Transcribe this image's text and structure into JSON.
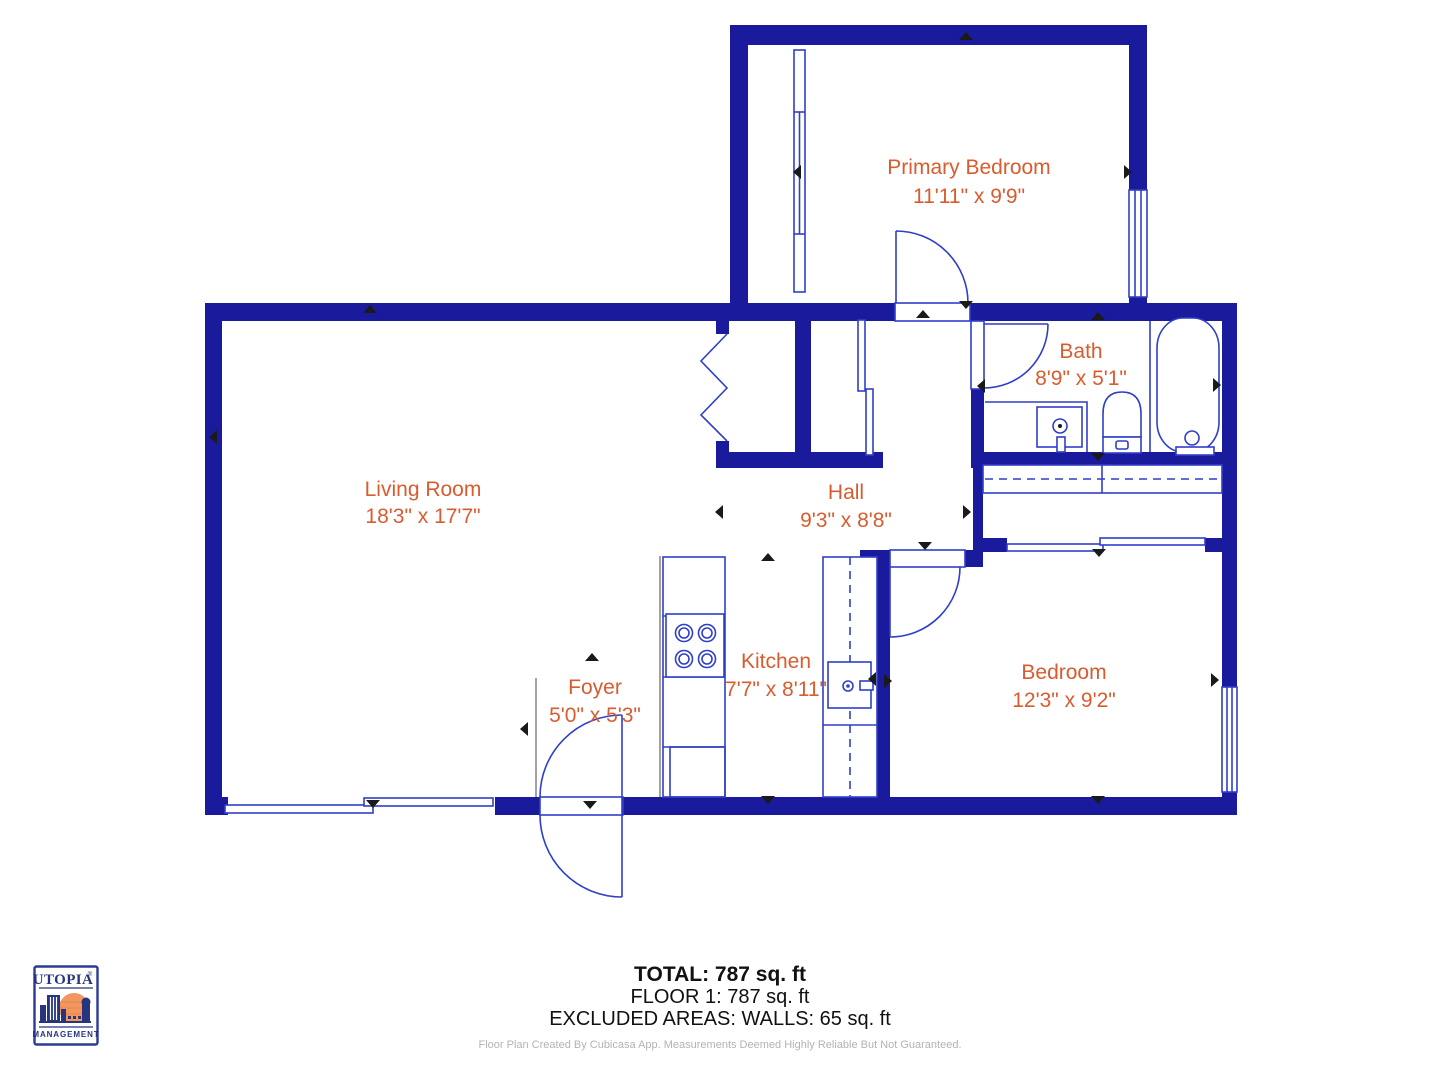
{
  "colors": {
    "wall_navy": "#1a1a9d",
    "fixture_blue": "#2f3fc6",
    "label_orange": "#d85c2e",
    "marker_black": "#1a1a1a",
    "logo_navy": "#27357f",
    "logo_orange": "#f2975f",
    "disclaimer_gray": "#b3b3b3"
  },
  "rooms": [
    {
      "name": "Primary Bedroom",
      "dims": "11'11\" x 9'9\""
    },
    {
      "name": "Bath",
      "dims": "8'9\" x 5'1\""
    },
    {
      "name": "Living Room",
      "dims": "18'3\" x 17'7\""
    },
    {
      "name": "Hall",
      "dims": "9'3\" x 8'8\""
    },
    {
      "name": "Kitchen",
      "dims": "7'7\" x 8'11\""
    },
    {
      "name": "Foyer",
      "dims": "5'0\" x 5'3\""
    },
    {
      "name": "Bedroom",
      "dims": "12'3\" x 9'2\""
    }
  ],
  "summary": {
    "total": "TOTAL: 787 sq. ft",
    "floor": "FLOOR 1: 787 sq. ft",
    "excluded": "EXCLUDED AREAS: WALLS: 65 sq. ft"
  },
  "disclaimer": "Floor Plan Created By Cubicasa App. Measurements Deemed Highly Reliable But Not Guaranteed.",
  "logo": {
    "brand": "UTOPIA",
    "registered": "®",
    "subtitle": "MANAGEMENT"
  }
}
